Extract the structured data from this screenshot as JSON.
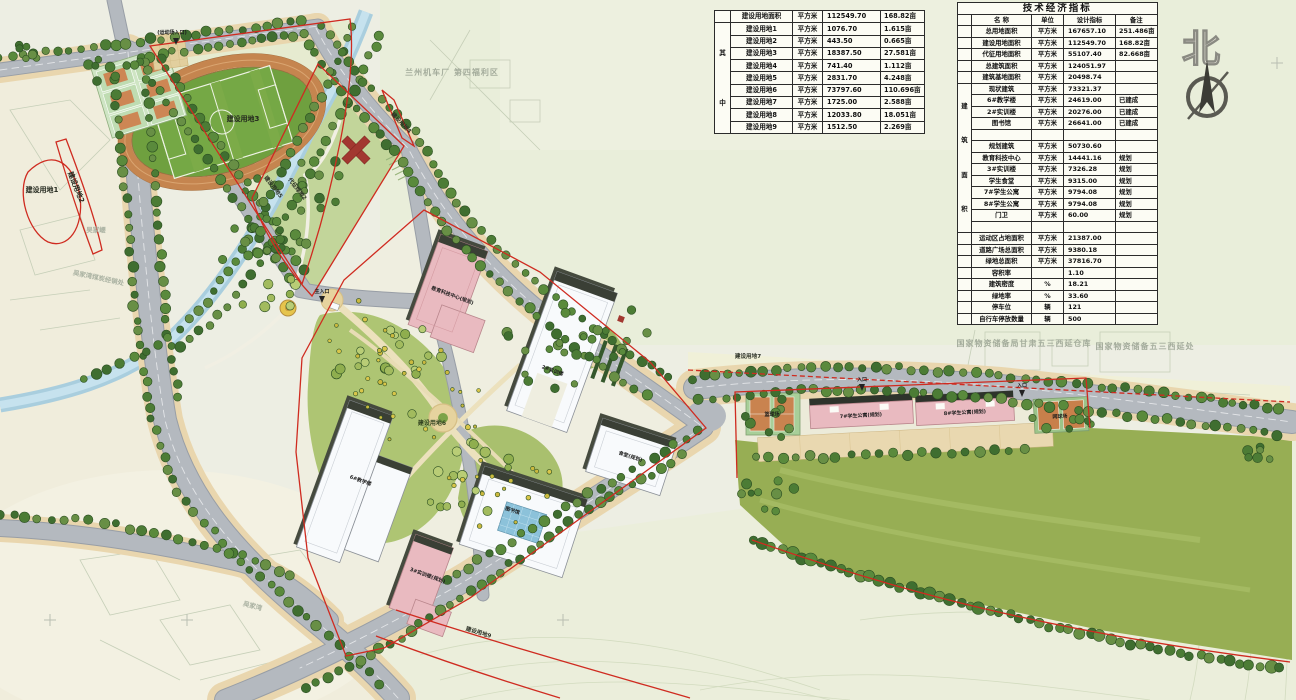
{
  "colors": {
    "boundary_red": "#cf2b20",
    "road_gray": "#b4b9bf",
    "canal_blue": "#a9cede",
    "lawn_green": "#97ae54",
    "track_terracotta": "#c5854f",
    "building_pink": "#e9bac0",
    "building_white": "#f8fafc",
    "tree_green": "#54823a",
    "table_bg": "#fcfcf4"
  },
  "compass": {
    "label": "北"
  },
  "labels": {
    "site1": "建设用地1",
    "site2": "建设用地2",
    "site3": "建设用地3",
    "site4": "建设用地4",
    "site5": "建设用地5",
    "site6": "建设用地6",
    "site7": "建设用地7",
    "site9": "建设用地9",
    "green2": "代征绿地2",
    "stadium_entrance": "(运动场入口)",
    "main_entrance": "主入口",
    "entrance": "入口",
    "edu_center": "教育科技中心(规划)",
    "trn2": "2#实训楼",
    "teach6": "6#教学楼",
    "library": "图书馆",
    "canteen": "食堂(规划)",
    "trn3": "3#实训楼(规划)",
    "dorm7": "7#学生公寓(规划)",
    "dorm8": "8#学生公寓(规划)",
    "bball": "篮球场",
    "tennis": "网球场",
    "factory": "兰州机车厂 第四福利区",
    "depot1": "国家物资储备局甘肃五三西延仓库",
    "depot2": "国家物资储备五三西延处",
    "wujiaya": "吴家崾",
    "wujiawan_coal": "吴家湾煤炭经销处",
    "wujiawan": "吴家湾"
  },
  "tables": {
    "land_use": {
      "side_label": "其中",
      "rows": [
        [
          "建设用地面积",
          "平方米",
          "112549.70",
          "168.82亩"
        ],
        [
          "建设用地1",
          "平方米",
          "1076.70",
          "1.615亩"
        ],
        [
          "建设用地2",
          "平方米",
          "443.50",
          "0.665亩"
        ],
        [
          "建设用地3",
          "平方米",
          "18387.50",
          "27.581亩"
        ],
        [
          "建设用地4",
          "平方米",
          "741.40",
          "1.112亩"
        ],
        [
          "建设用地5",
          "平方米",
          "2831.70",
          "4.248亩"
        ],
        [
          "建设用地6",
          "平方米",
          "73797.60",
          "110.696亩"
        ],
        [
          "建设用地7",
          "平方米",
          "1725.00",
          "2.588亩"
        ],
        [
          "建设用地8",
          "平方米",
          "12033.80",
          "18.051亩"
        ],
        [
          "建设用地9",
          "平方米",
          "1512.50",
          "2.269亩"
        ]
      ]
    },
    "indicators": {
      "title": "技术经济指标",
      "header": [
        "名  称",
        "单位",
        "设计指标",
        "备注"
      ],
      "side_label": "建筑面积",
      "rows": [
        [
          "总用地面积",
          "平方米",
          "167657.10",
          "251.486亩"
        ],
        [
          "建设用地面积",
          "平方米",
          "112549.70",
          "168.82亩"
        ],
        [
          "代征用地面积",
          "平方米",
          "55107.40",
          "82.668亩"
        ],
        [
          "总建筑面积",
          "平方米",
          "124051.97",
          ""
        ],
        [
          "建筑基地面积",
          "平方米",
          "20498.74",
          ""
        ],
        [
          "现状建筑",
          "平方米",
          "73321.37",
          ""
        ],
        [
          "6#教学楼",
          "平方米",
          "24619.00",
          "已建成"
        ],
        [
          "2#实训楼",
          "平方米",
          "20276.00",
          "已建成"
        ],
        [
          "图书馆",
          "平方米",
          "26641.00",
          "已建成"
        ],
        [
          "",
          "",
          "",
          ""
        ],
        [
          "规划建筑",
          "平方米",
          "50730.60",
          ""
        ],
        [
          "教育科技中心",
          "平方米",
          "14441.16",
          "规划"
        ],
        [
          "3#实训楼",
          "平方米",
          "7326.28",
          "规划"
        ],
        [
          "学生食堂",
          "平方米",
          "9315.00",
          "规划"
        ],
        [
          "7#学生公寓",
          "平方米",
          "9794.08",
          "规划"
        ],
        [
          "8#学生公寓",
          "平方米",
          "9794.08",
          "规划"
        ],
        [
          "门卫",
          "平方米",
          "60.00",
          "规划"
        ],
        [
          "",
          "",
          "",
          ""
        ],
        [
          "运动区占地面积",
          "平方米",
          "21387.00",
          ""
        ],
        [
          "道路广场总面积",
          "平方米",
          "9380.18",
          ""
        ],
        [
          "绿地总面积",
          "平方米",
          "37816.70",
          ""
        ],
        [
          "容积率",
          "",
          "1.10",
          ""
        ],
        [
          "建筑密度",
          "%",
          "18.21",
          ""
        ],
        [
          "绿地率",
          "%",
          "33.60",
          ""
        ],
        [
          "停车位",
          "辆",
          "121",
          ""
        ],
        [
          "自行车停放数量",
          "辆",
          "500",
          ""
        ]
      ]
    }
  }
}
